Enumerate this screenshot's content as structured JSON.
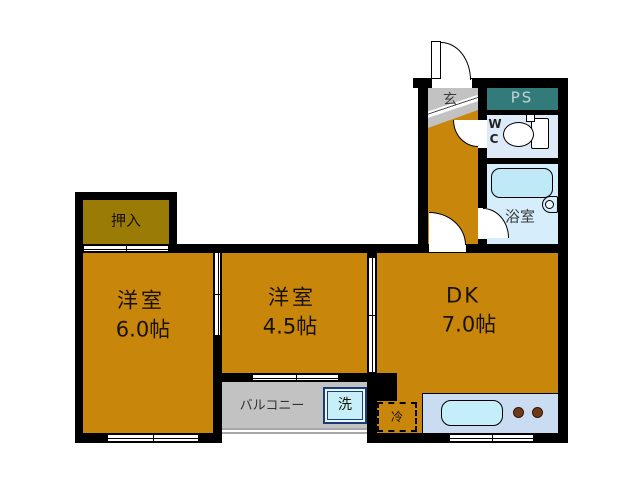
{
  "plan_title": "1DK floor plan",
  "rooms": {
    "closet": {
      "label": "押入"
    },
    "room6": {
      "name": "洋室",
      "size": "6.0帖"
    },
    "room45": {
      "name": "洋室",
      "size": "4.5帖"
    },
    "dk": {
      "name": "DK",
      "size": "7.0帖"
    },
    "genkan": {
      "label": "玄"
    },
    "ps": {
      "label": "PS"
    },
    "wc": {
      "line1": "W",
      "line2": "C"
    },
    "bath": {
      "label": "浴室"
    },
    "balcony": {
      "label": "バルコニー"
    }
  },
  "fixtures": {
    "washer": {
      "label": "洗"
    },
    "fridge": {
      "label": "冷"
    },
    "toilet_icon": "toilet",
    "bathtub_icon": "bathtub",
    "kitchen_sink_icon": "sink",
    "burner_count": 2
  },
  "colors": {
    "wall": "#000000",
    "room_floor": "#C8860B",
    "closet_floor": "#9A7B06",
    "gray_area": "#C2C2C2",
    "ps_fill": "#337A7A",
    "wc_fill": "#DDEAF8",
    "bath_fill": "#D6EDFC",
    "bathtub_fill": "#BFE9F7",
    "counter_fill": "#C9DCF2",
    "sink_fill": "#C4EFFA",
    "washer_fill": "#C6EFFA",
    "washer_border": "#1A3C78",
    "burner_fill": "#6F3A1A",
    "background": "#FFFFFF"
  }
}
